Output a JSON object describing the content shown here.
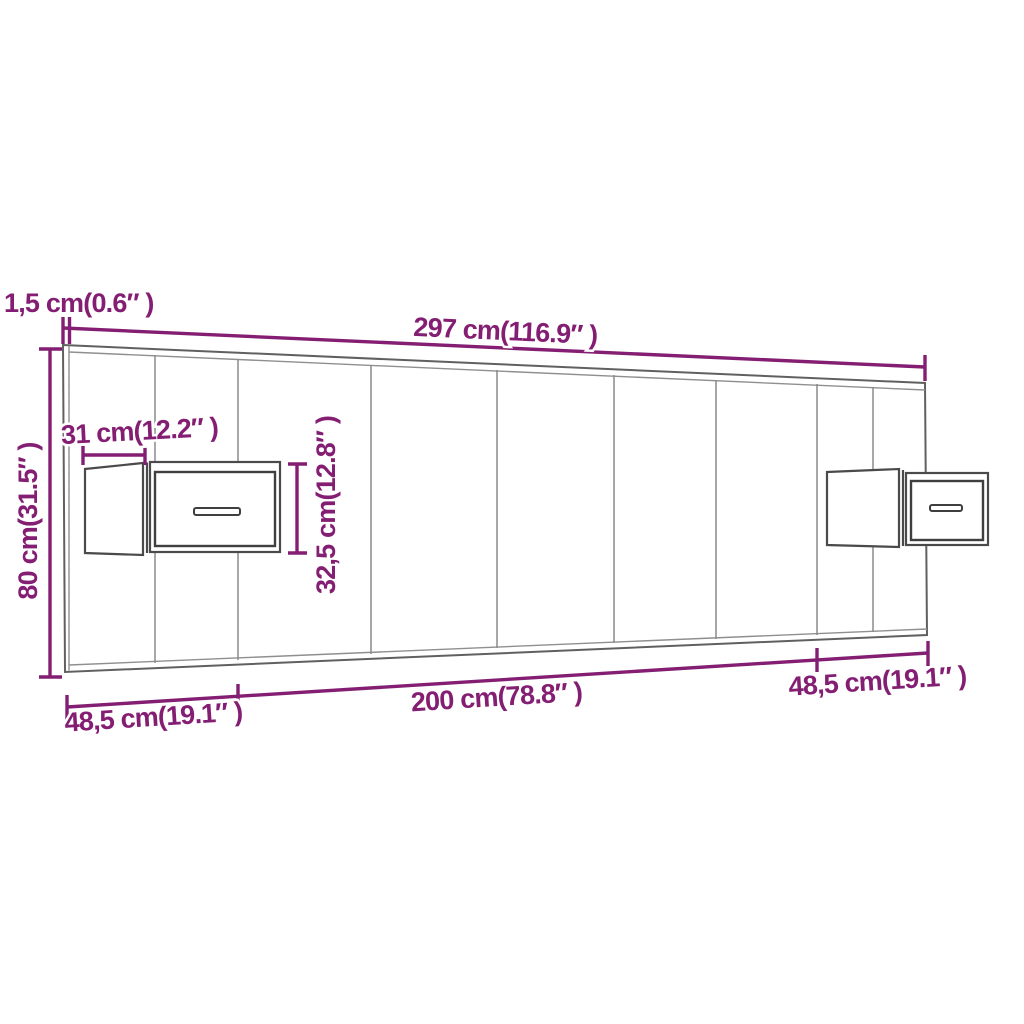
{
  "diagram": {
    "title": "Headboard with floating bedside cabinets - dimension diagram",
    "accent_color": "#841E73",
    "line_color_outline": "#606060",
    "line_color_divisions": "#8a8a8a",
    "background_color": "#ffffff"
  },
  "labels": {
    "panel_thickness": "1,5 cm(0.6″ )",
    "total_width": "297 cm(116.9″ )",
    "panel_height": "80 cm(31.5″ )",
    "cabinet_depth": "31 cm(12.2″ )",
    "cabinet_height": "32,5 cm(12.8″ )",
    "left_segment": "48,5 cm(19.1″ )",
    "center_segment": "200 cm(78.8″ )",
    "right_segment": "48,5 cm(19.1″ )"
  }
}
